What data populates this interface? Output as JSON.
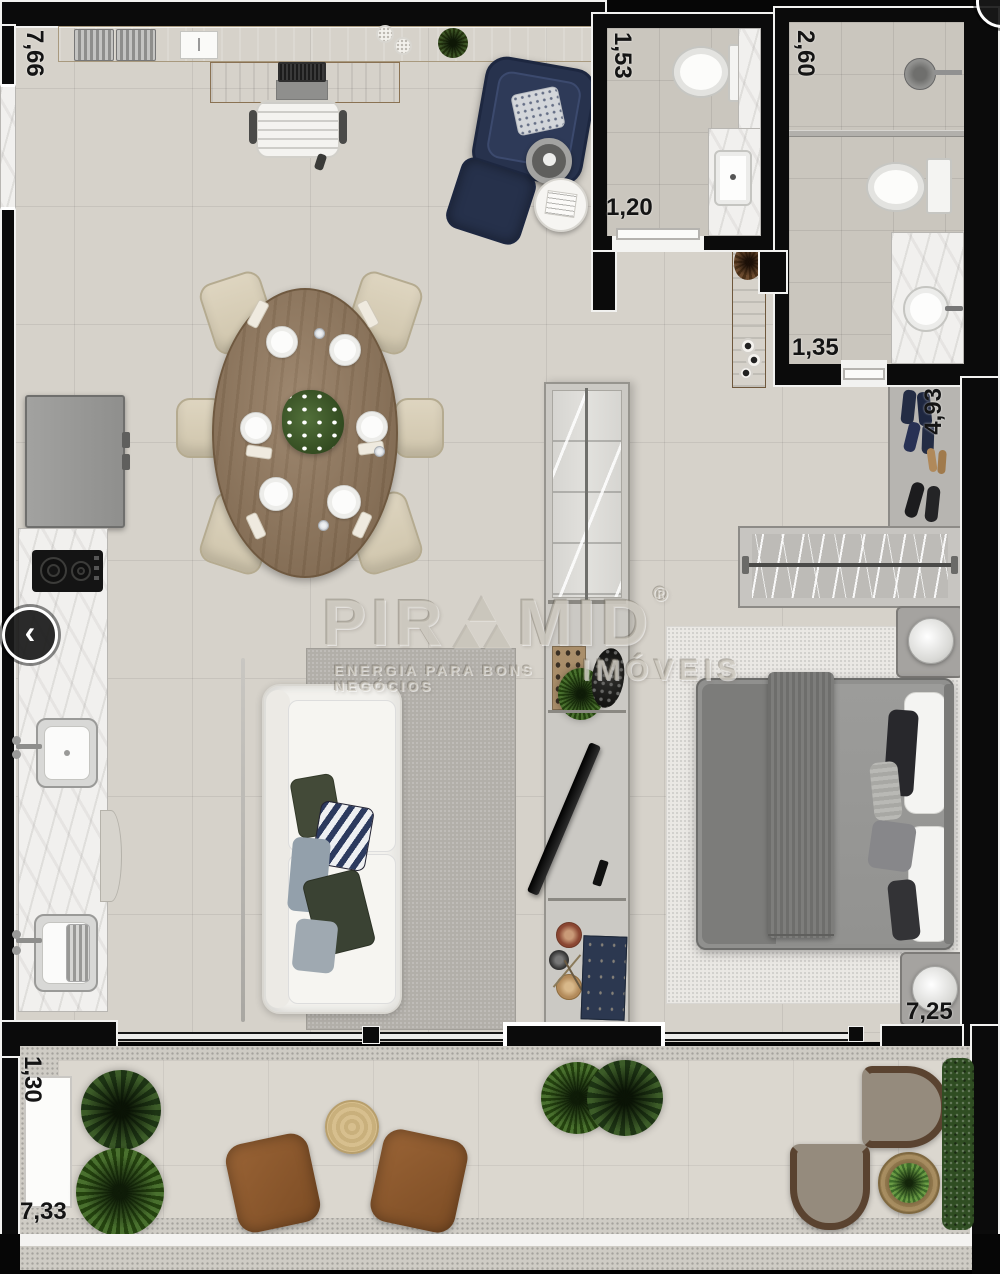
{
  "dimensions": {
    "top_width": "7,66",
    "bath1_width": "1,53",
    "bath1_depth": "1,20",
    "bath2_width": "2,60",
    "hall_door": "1,35",
    "closet_length": "4,93",
    "bedroom_width": "7,25",
    "balcony_depth": "1,30",
    "balcony_width": "7,33"
  },
  "watermark": {
    "brand_prefix": "PIR",
    "brand_suffix": "MID",
    "registered": "®",
    "tagline": "ENERGIA PARA BONS NEGÓCIOS",
    "division": "IMÓVEIS"
  },
  "ui": {
    "prev_label": "‹"
  },
  "colors": {
    "wall": "#0b0b0b",
    "floor": "#d6d2ca",
    "navy_furniture": "#2b3550",
    "table_wood": "#8d7357",
    "rug_gray": "#b2afa9",
    "balcony_floor": "#dbd7cf"
  }
}
